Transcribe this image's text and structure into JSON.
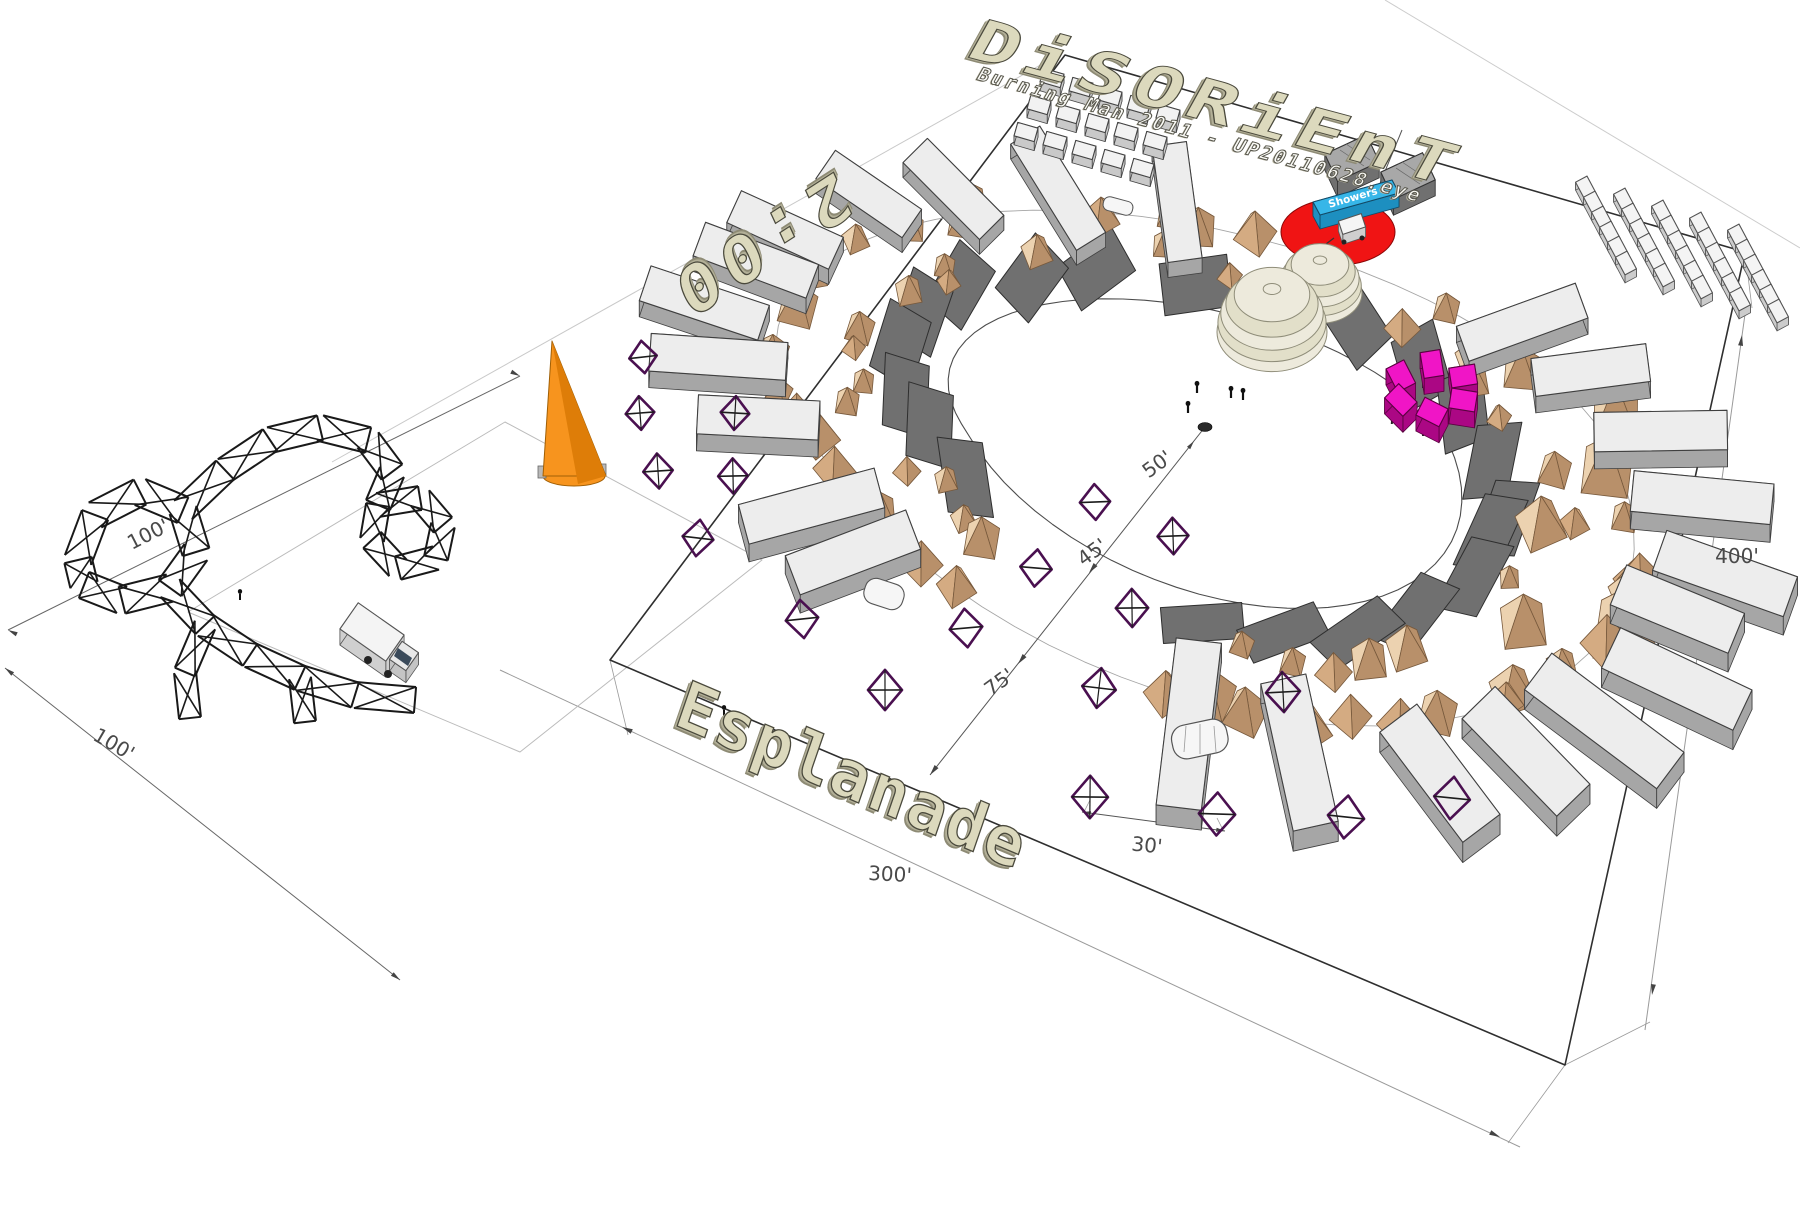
{
  "title": "DiSORiEnT",
  "subtitle": "Burning Man 2011 - UP20110628.eye",
  "street_label": "2:00",
  "road_label": "Esplanade",
  "showers_label": "Showers",
  "dimensions": {
    "d50": "50'",
    "d45": "45'",
    "d75": "75'",
    "d30": "30'",
    "d300": "300'",
    "d400": "400'",
    "d100a": "100'",
    "d100b": "100'"
  },
  "colors": {
    "ground_text": "#dcd9bd",
    "engraved_text": "#fafaf5",
    "dimension_text": "#4a4a4a",
    "red_pad": "#f01414",
    "shower_sign_blue": "#37b6e8",
    "shower_sign_side": "#1d8fc0",
    "magenta_tower": "#f015c6",
    "magenta_side": "#ab0784",
    "orange_cone": "#f7941e",
    "orange_cone_shade": "#de7d08",
    "dome_cream": "#edeadc",
    "dome_cream_dark": "#e2dfc9",
    "tent_bright": "#ecd2b0",
    "tent_mid": "#d4ab82",
    "tent_dark": "#b8906a",
    "rv_top": "#ededed",
    "rv_side": "#a6a6a6",
    "shade_panel": "#707070",
    "diamond_purple": "#4a1050",
    "truss_black": "#191919",
    "boundary": "#2f2f2f"
  },
  "scene": {
    "center": {
      "x": 1205,
      "y": 432
    },
    "camp_plot_corners": [
      [
        610,
        660
      ],
      [
        1065,
        55
      ],
      [
        1745,
        252
      ],
      [
        1565,
        1065
      ]
    ],
    "art_plot_corners": [
      [
        188,
        612
      ],
      [
        505,
        422
      ],
      [
        762,
        560
      ],
      [
        520,
        752
      ]
    ],
    "diamonds": [
      [
        643,
        357
      ],
      [
        640,
        413
      ],
      [
        658,
        471
      ],
      [
        698,
        538
      ],
      [
        735,
        413
      ],
      [
        733,
        476
      ],
      [
        1095,
        502
      ],
      [
        1036,
        568
      ],
      [
        1132,
        608
      ],
      [
        1173,
        536
      ],
      [
        802,
        619
      ],
      [
        885,
        690
      ],
      [
        966,
        628
      ],
      [
        1099,
        688
      ],
      [
        1283,
        692
      ],
      [
        1090,
        797
      ],
      [
        1217,
        814
      ],
      [
        1346,
        817
      ],
      [
        1452,
        798
      ]
    ]
  }
}
